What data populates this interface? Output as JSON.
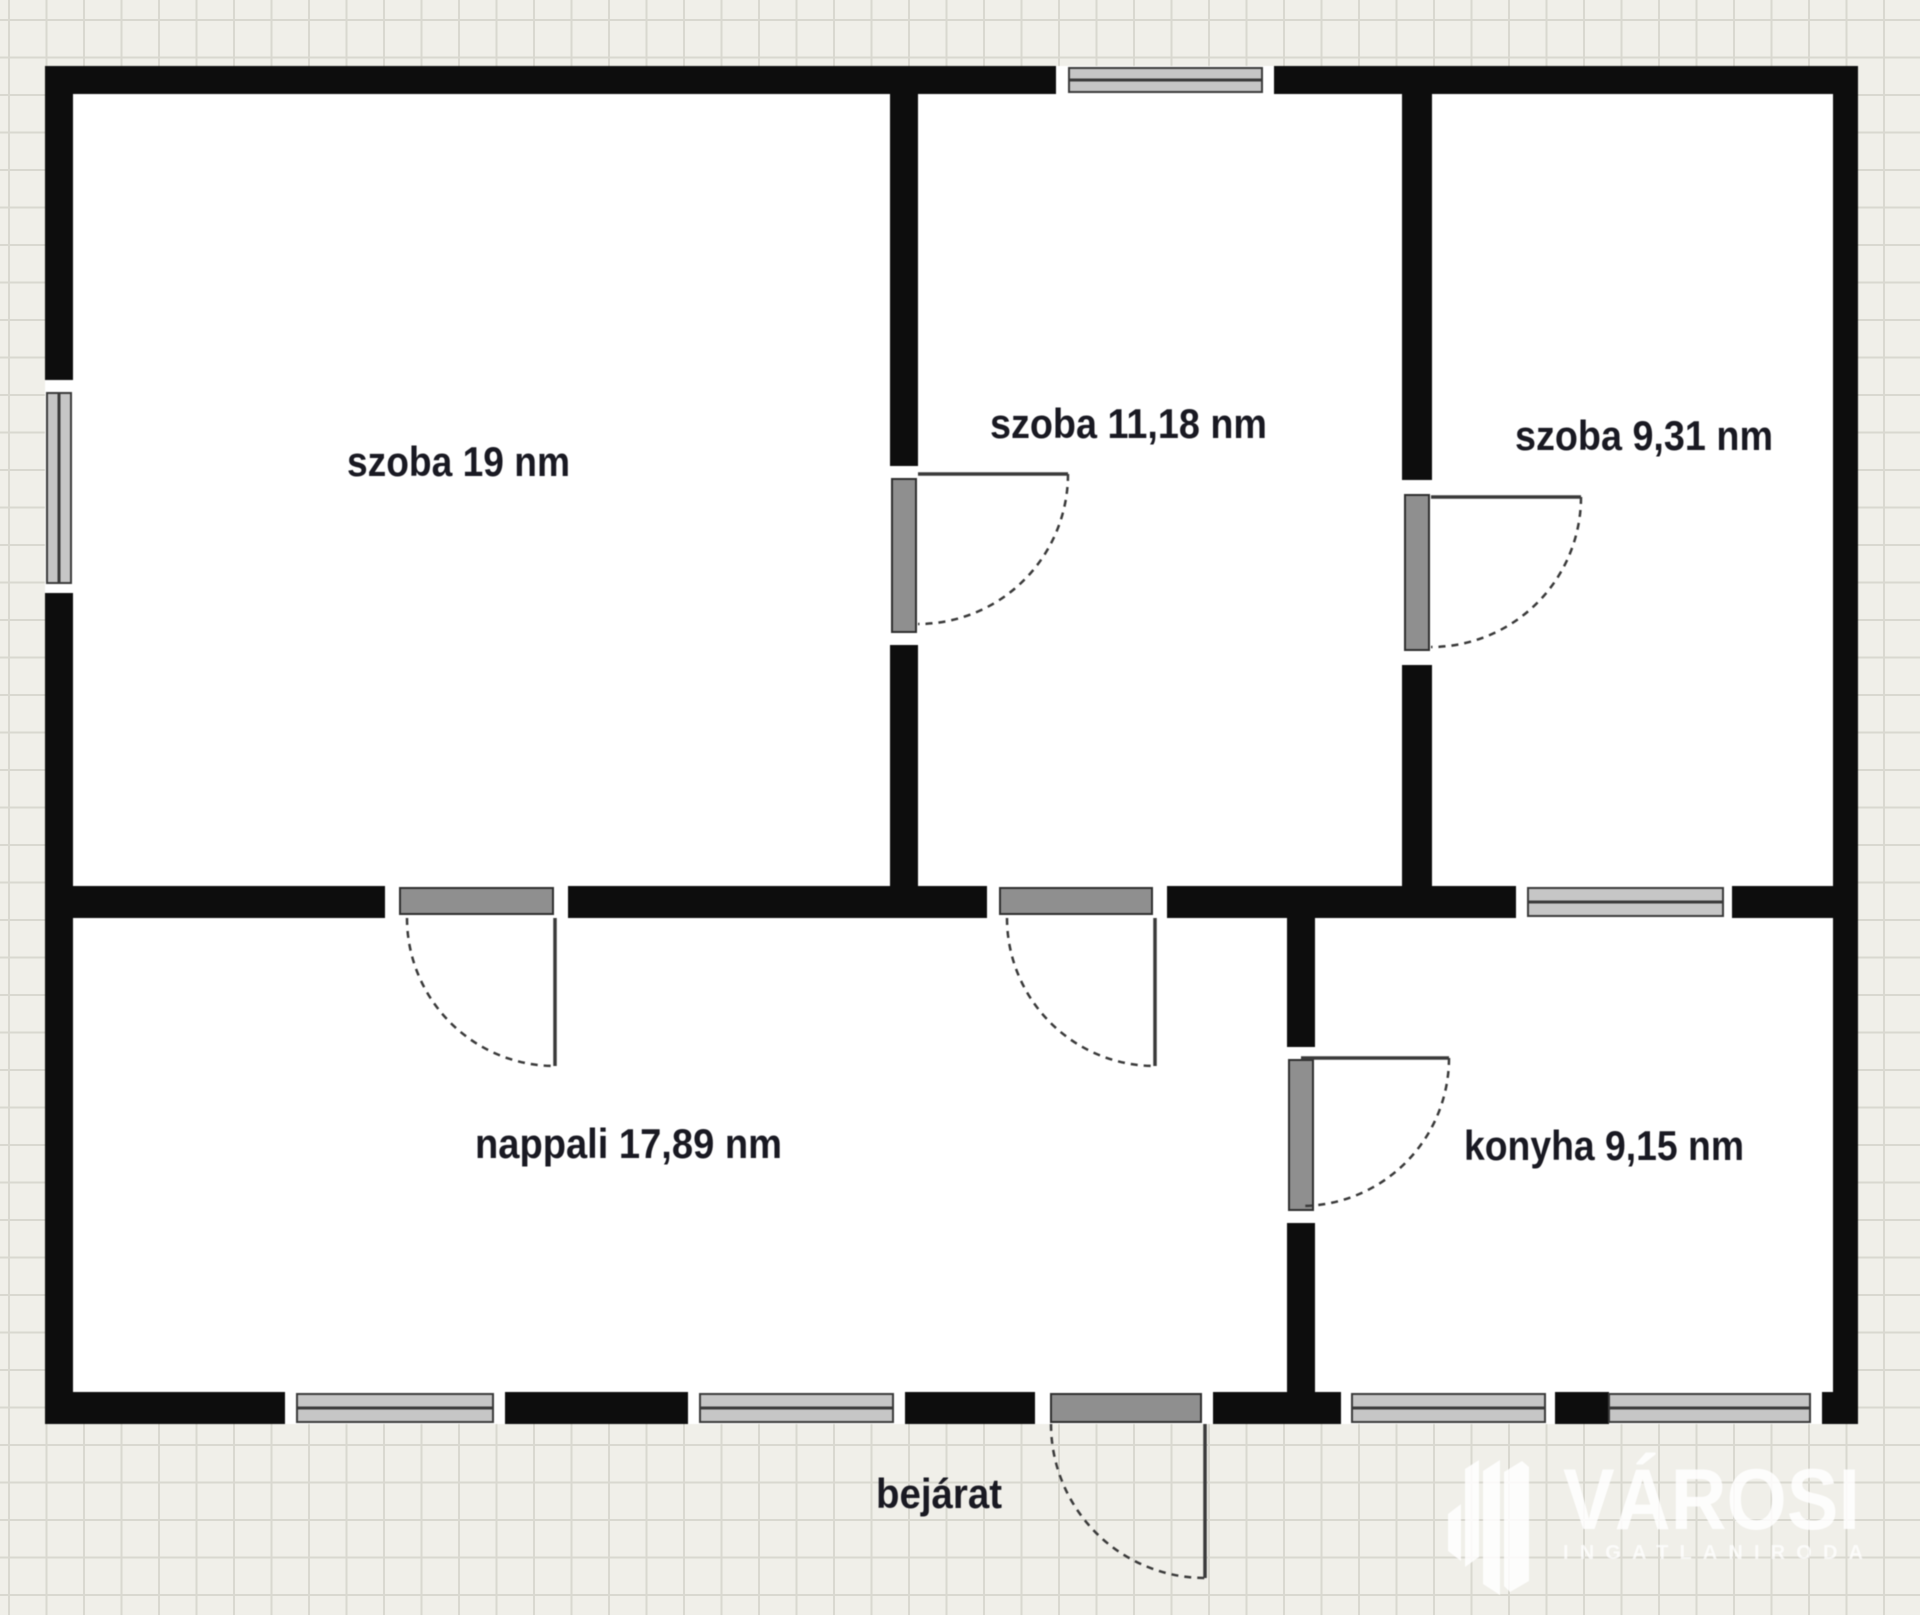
{
  "canvas": {
    "width": 1920,
    "height": 1615,
    "grid_cell": 37.5
  },
  "colors": {
    "background": "#f0efe9",
    "grid_line": "#d9d8d0",
    "wall": "#0d0d0d",
    "interior": "#ffffff",
    "cap": "#ffffff",
    "door_line": "#3a3a3a",
    "door_leaf": "#8f8f8f",
    "door_leaf_border": "#2e2e2e",
    "window_glass": "#c6c6c6",
    "window_line": "#3a3a3a",
    "label_text": "#191922",
    "watermark": "rgba(255,255,255,0.85)",
    "watermark_tag": "rgba(255,255,255,0.75)"
  },
  "chart_data": {
    "type": "floorplan",
    "rooms": [
      {
        "name": "szoba",
        "area_sqm": "19",
        "label": "szoba 19 nm"
      },
      {
        "name": "szoba",
        "area_sqm": "11,18",
        "label": "szoba 11,18 nm"
      },
      {
        "name": "szoba",
        "area_sqm": "9,31",
        "label": "szoba 9,31 nm"
      },
      {
        "name": "nappali",
        "area_sqm": "17,89",
        "label": "nappali 17,89 nm"
      },
      {
        "name": "konyha",
        "area_sqm": "9,15",
        "label": "konyha 9,15 nm"
      }
    ],
    "entrance_label": "bejárat",
    "unit": "nm"
  },
  "plan": {
    "interior": {
      "x": 45,
      "y": 66,
      "w": 1813,
      "h": 1358
    },
    "walls": [
      [
        45,
        66,
        1011,
        28
      ],
      [
        1274,
        66,
        584,
        28
      ],
      [
        45,
        66,
        28,
        314
      ],
      [
        45,
        593,
        28,
        831
      ],
      [
        1833,
        66,
        25,
        1358
      ],
      [
        45,
        1392,
        240,
        32
      ],
      [
        505,
        1392,
        183,
        32
      ],
      [
        905,
        1392,
        130,
        32
      ],
      [
        1213,
        1392,
        128,
        32
      ],
      [
        1555,
        1392,
        54,
        32
      ],
      [
        1822,
        1392,
        36,
        32
      ],
      [
        73,
        886,
        312,
        32
      ],
      [
        568,
        886,
        419,
        32
      ],
      [
        1167,
        886,
        349,
        32
      ],
      [
        1732,
        886,
        101,
        32
      ],
      [
        890,
        94,
        28,
        372
      ],
      [
        890,
        645,
        28,
        241
      ],
      [
        1402,
        94,
        30,
        386
      ],
      [
        1402,
        665,
        30,
        221
      ],
      [
        1287,
        918,
        28,
        129
      ],
      [
        1287,
        1223,
        28,
        169
      ]
    ],
    "caps": [
      [
        1056,
        66,
        13,
        28
      ],
      [
        1262,
        66,
        12,
        28
      ],
      [
        45,
        380,
        28,
        13
      ],
      [
        45,
        583,
        28,
        10
      ],
      [
        285,
        1392,
        12,
        32
      ],
      [
        493,
        1392,
        12,
        32
      ],
      [
        688,
        1392,
        12,
        32
      ],
      [
        893,
        1392,
        12,
        32
      ],
      [
        1035,
        1392,
        16,
        32
      ],
      [
        1201,
        1392,
        12,
        32
      ],
      [
        1341,
        1392,
        11,
        32
      ],
      [
        1545,
        1392,
        10,
        32
      ],
      [
        1810,
        1392,
        12,
        32
      ],
      [
        385,
        886,
        15,
        32
      ],
      [
        553,
        886,
        15,
        32
      ],
      [
        987,
        886,
        13,
        32
      ],
      [
        1152,
        886,
        15,
        32
      ],
      [
        1516,
        886,
        12,
        32
      ],
      [
        1723,
        886,
        9,
        32
      ],
      [
        890,
        466,
        28,
        13
      ],
      [
        890,
        632,
        28,
        13
      ],
      [
        1402,
        480,
        30,
        15
      ],
      [
        1402,
        650,
        30,
        15
      ],
      [
        1287,
        1047,
        28,
        13
      ],
      [
        1287,
        1210,
        28,
        13
      ]
    ],
    "windows": [
      {
        "x": 1069,
        "y": 68,
        "w": 193,
        "h": 24,
        "o": "h"
      },
      {
        "x": 47,
        "y": 393,
        "w": 24,
        "h": 190,
        "o": "v"
      },
      {
        "x": 297,
        "y": 1394,
        "w": 196,
        "h": 28,
        "o": "h"
      },
      {
        "x": 700,
        "y": 1394,
        "w": 193,
        "h": 28,
        "o": "h"
      },
      {
        "x": 1352,
        "y": 1394,
        "w": 193,
        "h": 28,
        "o": "h"
      },
      {
        "x": 1609,
        "y": 1394,
        "w": 201,
        "h": 28,
        "o": "h"
      },
      {
        "x": 1528,
        "y": 888,
        "w": 195,
        "h": 28,
        "o": "h"
      }
    ],
    "door_leaves": [
      [
        892,
        479,
        24,
        153
      ],
      [
        1405,
        495,
        24,
        155
      ],
      [
        1289,
        1060,
        24,
        150
      ],
      [
        400,
        888,
        153,
        26
      ],
      [
        1000,
        888,
        152,
        26
      ],
      [
        1051,
        1394,
        150,
        28
      ]
    ],
    "door_swings": [
      {
        "line": [
          918,
          474,
          1068,
          474
        ],
        "arc": "M 1068,474 A 150,150 0 0 1 918,624"
      },
      {
        "line": [
          1431,
          497,
          1581,
          497
        ],
        "arc": "M 1581,497 A 150,150 0 0 1 1431,647"
      },
      {
        "line": [
          555,
          918,
          555,
          1066
        ],
        "arc": "M 407,918 A 148,148 0 0 0 555,1066"
      },
      {
        "line": [
          1155,
          918,
          1155,
          1066
        ],
        "arc": "M 1007,918 A 148,148 0 0 0 1155,1066"
      },
      {
        "line": [
          1301,
          1058,
          1449,
          1058
        ],
        "arc": "M 1449,1058 A 148,148 0 0 1 1301,1206"
      },
      {
        "line": [
          1205,
          1424,
          1205,
          1578
        ],
        "arc": "M 1051,1424 A 154,154 0 0 0 1205,1578"
      }
    ],
    "labels": [
      {
        "text": "szoba 19 nm",
        "x": 347,
        "y": 476,
        "len": 223
      },
      {
        "text": "szoba 11,18 nm",
        "x": 990,
        "y": 438,
        "len": 277
      },
      {
        "text": "szoba 9,31 nm",
        "x": 1515,
        "y": 450,
        "len": 258
      },
      {
        "text": "nappali 17,89 nm",
        "x": 475,
        "y": 1158,
        "len": 307
      },
      {
        "text": "konyha 9,15 nm",
        "x": 1464,
        "y": 1160,
        "len": 280
      },
      {
        "text": "bejárat",
        "x": 876,
        "y": 1508,
        "len": 126
      }
    ]
  },
  "watermark": {
    "brand": "VÁROSI",
    "tagline": "INGATLANIRODA",
    "brand_x": 1563,
    "brand_y": 1529,
    "brand_len": 297,
    "brand_size": 86,
    "tag_x": 1563,
    "tag_y": 1559,
    "tag_len": 300,
    "tag_size": 20,
    "logo_polys": [
      "1448,1514 1461,1504 1461,1561 1448,1551",
      "1465,1469 1479,1460 1479,1557 1465,1567",
      "1483,1471 1500,1460 1500,1595 1483,1584",
      "1504,1472 1522,1461 1529,1467 1529,1581 1510,1592 1504,1586"
    ]
  }
}
